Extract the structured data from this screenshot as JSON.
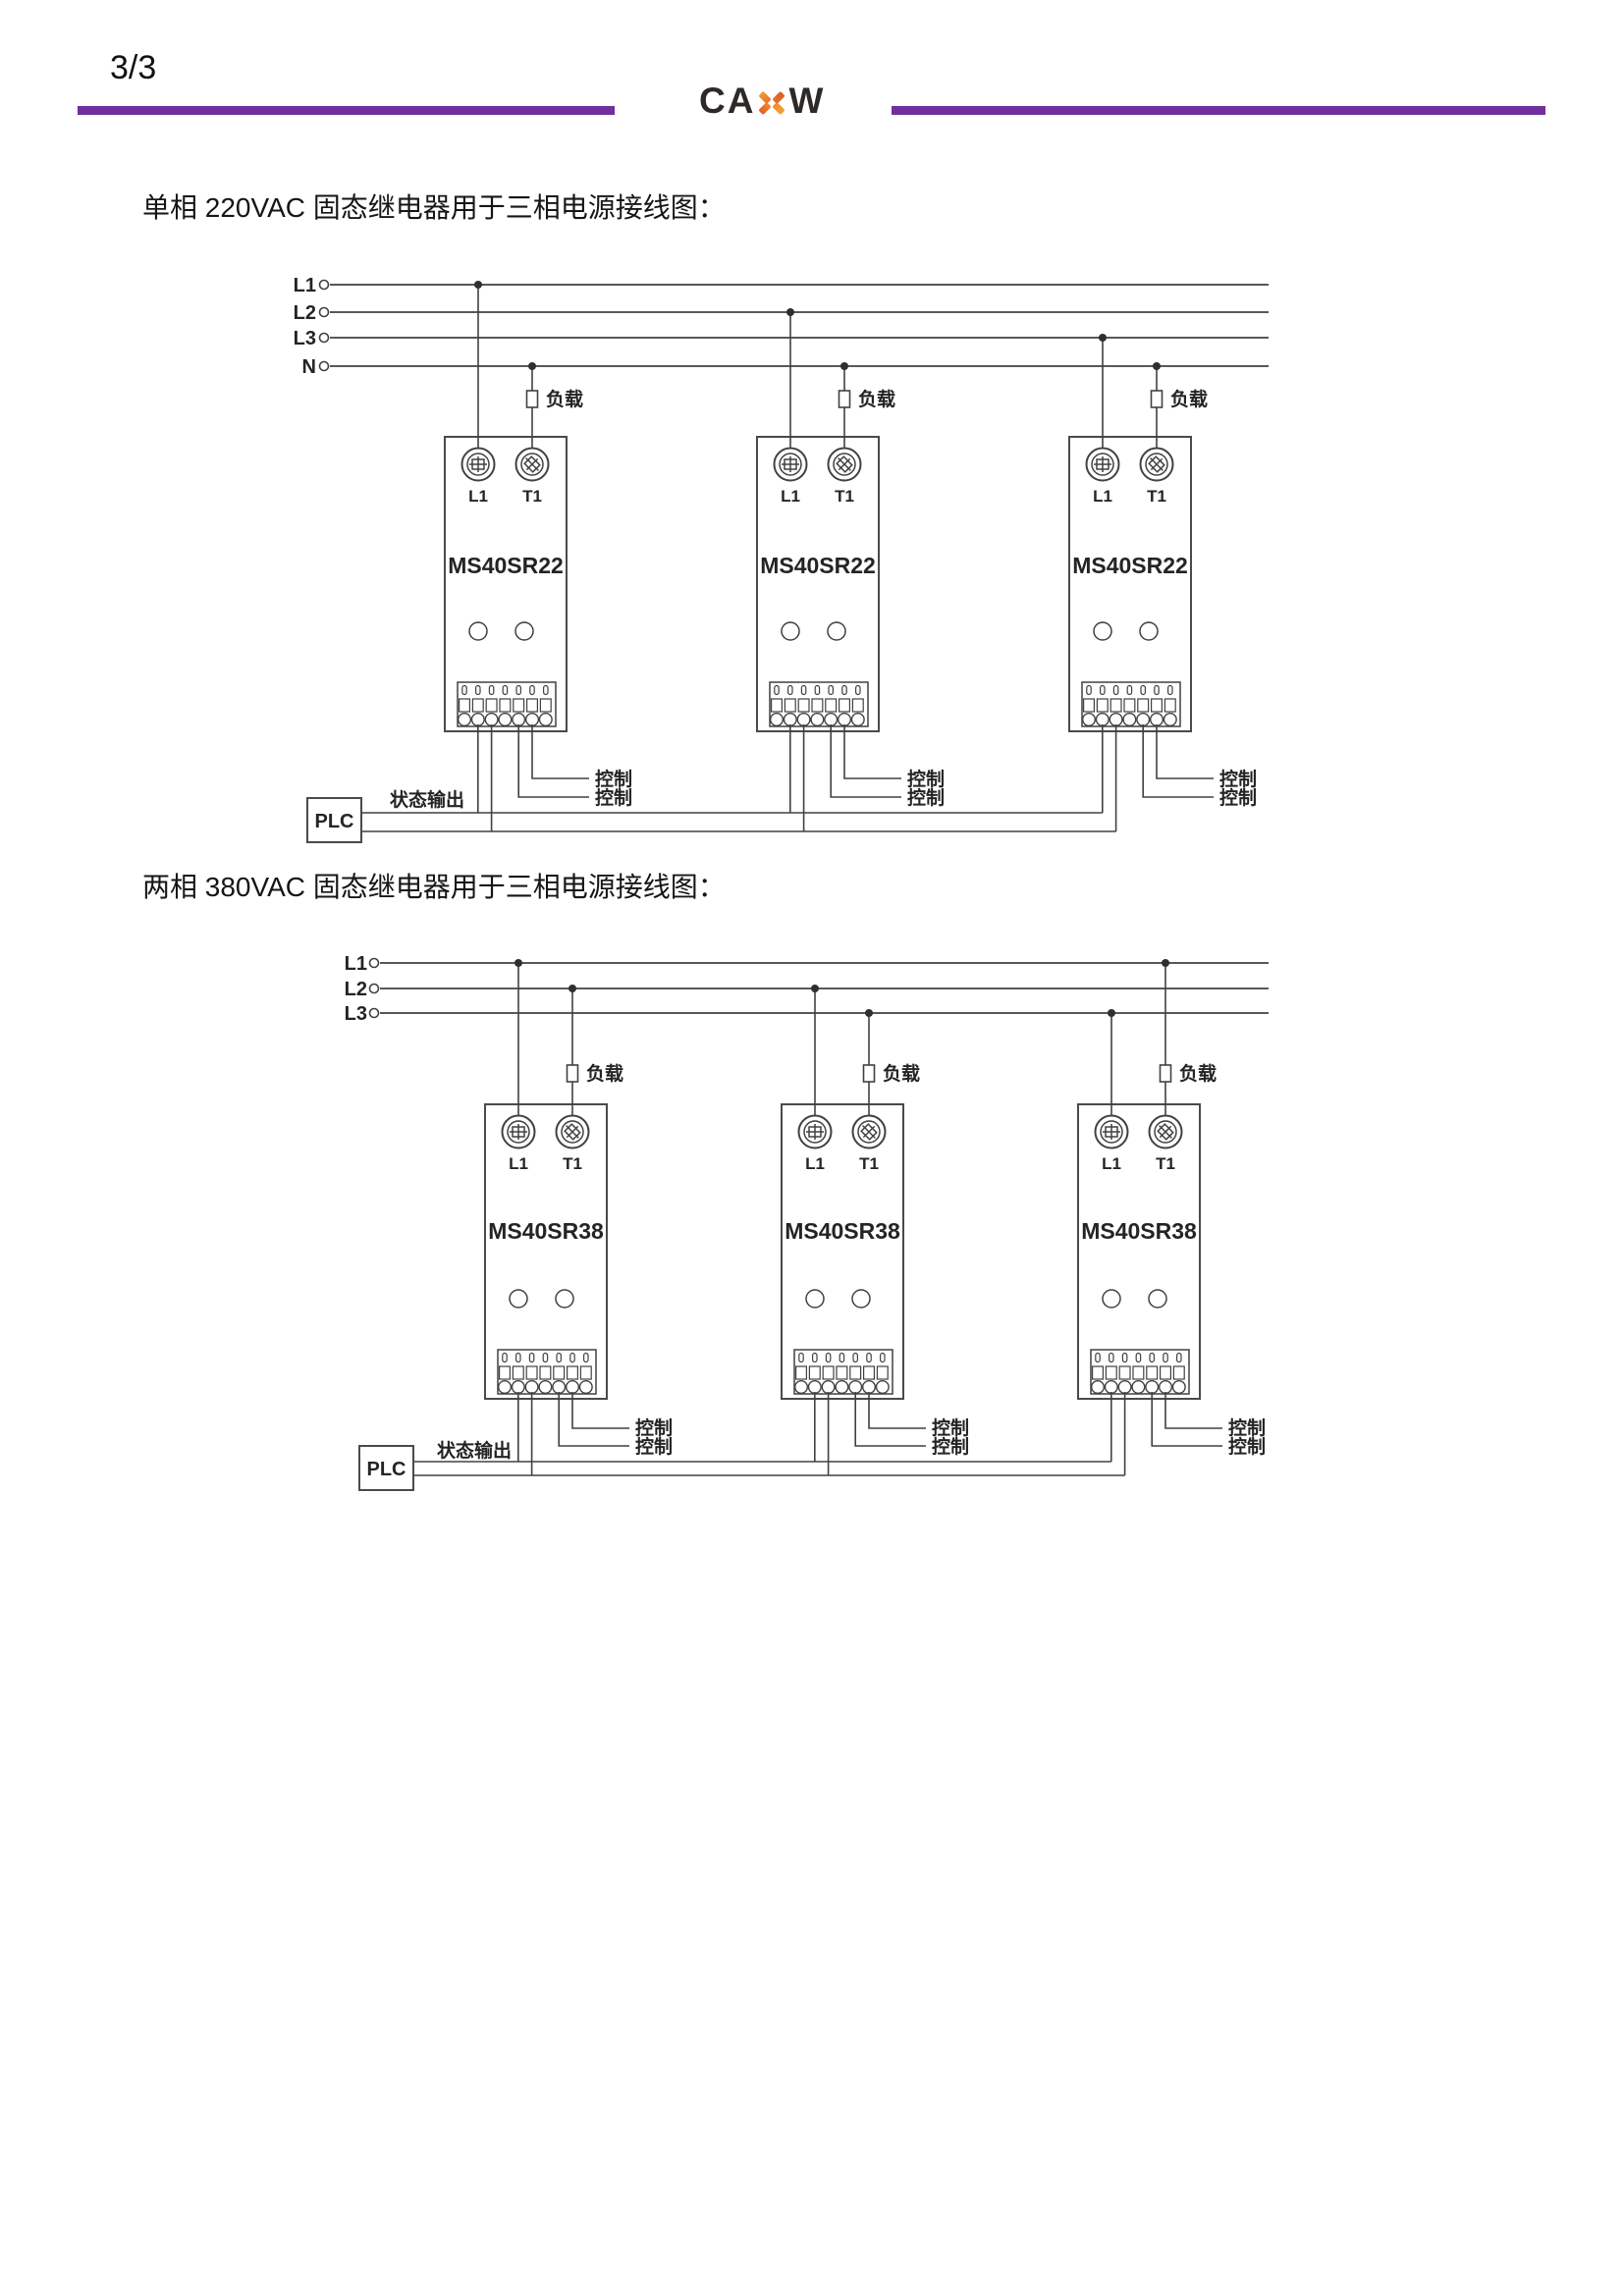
{
  "page": {
    "number": "3/3"
  },
  "logo": {
    "text_left": "CA",
    "text_right": "W",
    "x_icon": "orange-x-mark"
  },
  "colors": {
    "rule_purple": "#7030A0",
    "logo_dark": "#2E2927",
    "logo_orange": "#F09A30",
    "logo_orange_deep": "#DD5A26",
    "diagram_line": "#414141"
  },
  "relay": {
    "terminal_left": "L1",
    "terminal_right": "T1"
  },
  "diagram1": {
    "title": "单相 220VAC 固态继电器用于三相电源接线图：",
    "bus_labels": [
      "L1",
      "L2",
      "L3",
      "N"
    ],
    "model": "MS40SR22",
    "load_label": "负载",
    "control_label": "控制",
    "status_output_label": "状态输出",
    "plc_label": "PLC"
  },
  "diagram2": {
    "title": "两相 380VAC 固态继电器用于三相电源接线图：",
    "bus_labels": [
      "L1",
      "L2",
      "L3"
    ],
    "model": "MS40SR38",
    "load_label": "负载",
    "control_label": "控制",
    "status_output_label": "状态输出",
    "plc_label": "PLC"
  }
}
